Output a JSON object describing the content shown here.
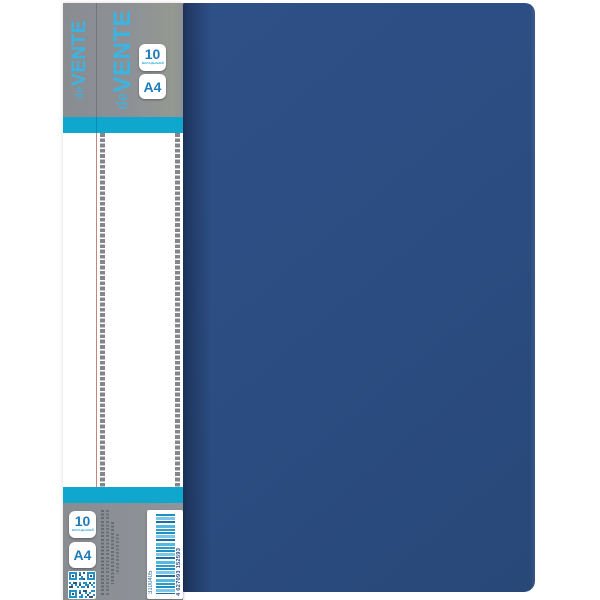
{
  "product": {
    "brand": {
      "prefix": "de",
      "name": "VENTE"
    },
    "capacity_badge": {
      "value": "10",
      "subtitle": "ВКЛАДЫШЕЙ"
    },
    "format_badge": {
      "value": "A4"
    },
    "barcode": {
      "article": "3100405",
      "ean": "4 627093 152593"
    }
  },
  "colors": {
    "folder_blue": "#2b4d82",
    "spine_shadow_blue": "#1f3a66",
    "panel_grey": "#8d9196",
    "accent_cyan": "#10a7cf",
    "logo_cyan": "#3ab5e2",
    "badge_text_blue": "#1e7db8",
    "checker_light": "#d8dadc",
    "checker_dark": "#83878c",
    "barcode_blue": "#218fc4",
    "seam_red": "#b25e4a"
  }
}
